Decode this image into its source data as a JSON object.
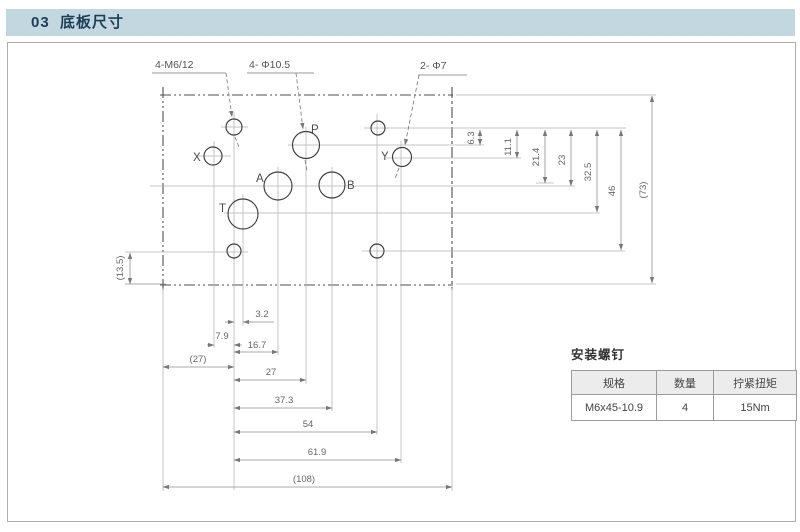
{
  "title_bar": {
    "text": "03  底板尺寸"
  },
  "colors": {
    "title_bar_bg": "#c3d7e0",
    "title_text": "#1d3e54",
    "outline_line": "#4f4f4f",
    "dimension_line": "#8f8f8f",
    "table_header_bg": "#ececec"
  },
  "drawing": {
    "callouts": {
      "m6": "4-M6/12",
      "d10_5": "4- Φ10.5",
      "d7": "2- Φ7"
    },
    "ports": {
      "p": "P",
      "x": "X",
      "y": "Y",
      "a": "A",
      "b": "B",
      "t": "T"
    },
    "dims_bottom": {
      "d3_2": "3.2",
      "d7_9": "7.9",
      "d16_7": "16.7",
      "d27p": "(27)",
      "d27": "27",
      "d37_3": "37.3",
      "d54": "54",
      "d61_9": "61.9",
      "d108": "(108)"
    },
    "dims_right": {
      "d6_3": "6.3",
      "d11_1": "11.1",
      "d21_4": "21.4",
      "d23": "23",
      "d32_5": "32.5",
      "d46": "46",
      "d73": "(73)"
    },
    "dims_left": {
      "d13_5": "(13.5)"
    }
  },
  "screw_table": {
    "title": "安装螺钉",
    "headers": [
      "规格",
      "数量",
      "拧紧扭矩"
    ],
    "row": [
      "M6x45-10.9",
      "4",
      "15Nm"
    ]
  }
}
